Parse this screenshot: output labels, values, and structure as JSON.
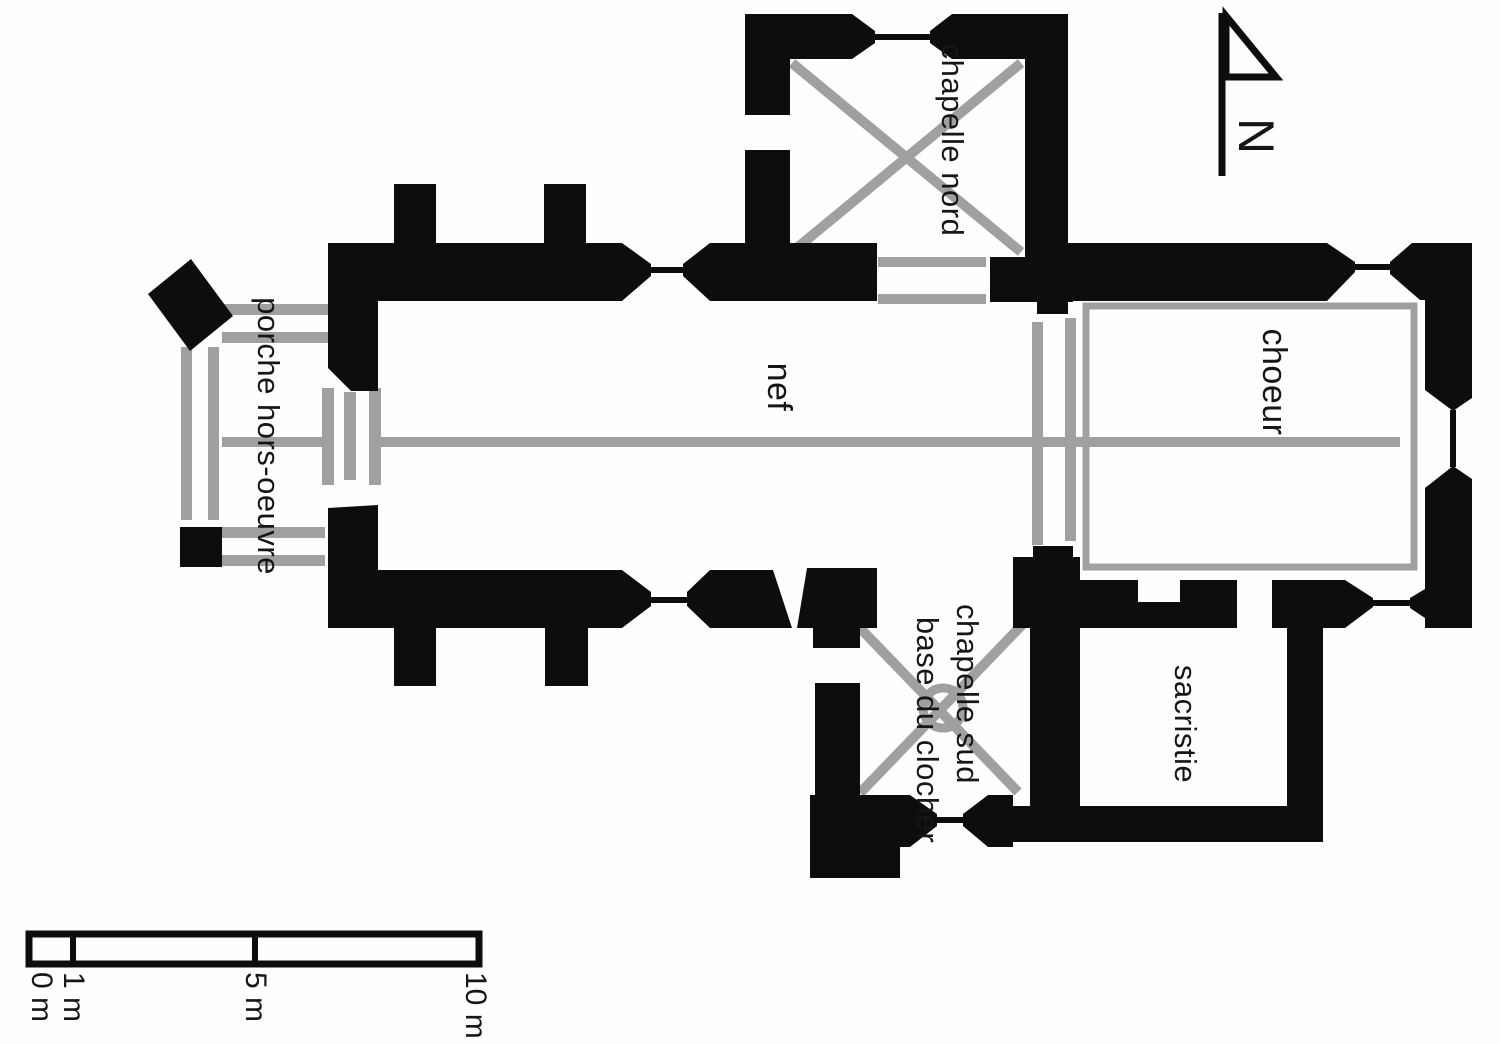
{
  "plan": {
    "rooms": {
      "chapelle_nord": "chapelle nord",
      "nef": "nef",
      "choeur": "choeur",
      "porche": "porche hors-oeuvre",
      "chapelle_sud_line1": "chapelle sud",
      "chapelle_sud_line2": "base du clocher",
      "sacristie": "sacristie"
    },
    "north_arrow": {
      "label": "N"
    },
    "scale_bar": {
      "ticks": [
        "0 m",
        "1 m",
        "5 m",
        "10 m"
      ]
    },
    "colors": {
      "wall_black": "#0d0d0d",
      "masonry_gray": "#a0a0a0",
      "paper_white": "#fefefe"
    }
  }
}
